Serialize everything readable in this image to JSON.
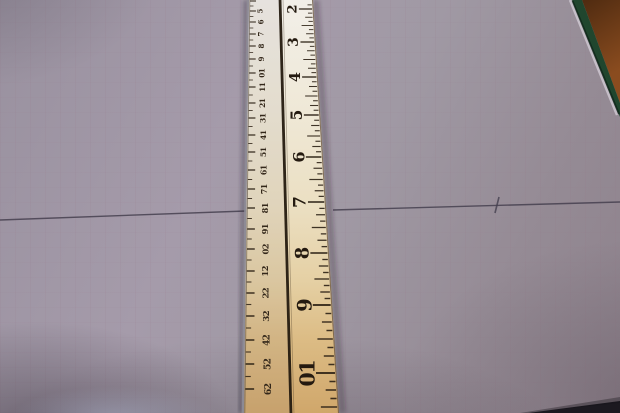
{
  "scene": {
    "colors": {
      "paper_base": "#9d95a1",
      "ruler_top": "#f2efe9",
      "ruler_mid": "#ebdfc2",
      "ruler_bottom": "#d0a76b",
      "marking_dark": "#2b2014",
      "cm_label_color": "#33271a",
      "inch_label_color": "#241a10",
      "pencil": "#45404f",
      "mat_green": "#20462e",
      "wood_dark": "#4e2a10",
      "wood_light": "#8a4c1f",
      "bottom_shadow": "#141118",
      "edge_gray": "#8e8c96"
    },
    "ruler": {
      "geometry": {
        "left_top_x": 249,
        "left_bottom_x": 244,
        "divider_top_x": 280,
        "divider_bottom_x": 291,
        "right_top_x": 313,
        "right_bottom_x": 339,
        "height": 413
      },
      "cm_scale": {
        "unit": "cm",
        "labels": [
          {
            "n": "5",
            "y": 11
          },
          {
            "n": "6",
            "y": 22
          },
          {
            "n": "7",
            "y": 34
          },
          {
            "n": "8",
            "y": 46
          },
          {
            "n": "9",
            "y": 59
          },
          {
            "n": "10",
            "y": 73
          },
          {
            "n": "11",
            "y": 87
          },
          {
            "n": "12",
            "y": 103
          },
          {
            "n": "13",
            "y": 118
          },
          {
            "n": "14",
            "y": 135
          },
          {
            "n": "15",
            "y": 152
          },
          {
            "n": "16",
            "y": 170
          },
          {
            "n": "17",
            "y": 189
          },
          {
            "n": "18",
            "y": 208
          },
          {
            "n": "19",
            "y": 229
          },
          {
            "n": "20",
            "y": 249
          },
          {
            "n": "21",
            "y": 271
          },
          {
            "n": "22",
            "y": 293
          },
          {
            "n": "23",
            "y": 316
          },
          {
            "n": "24",
            "y": 340
          },
          {
            "n": "25",
            "y": 364
          },
          {
            "n": "26",
            "y": 389
          }
        ],
        "extra_tick_y": 1
      },
      "inch_scale": {
        "unit": "inch",
        "subdivisions_per_inch": 8,
        "labels": [
          {
            "n": "2",
            "y": 9
          },
          {
            "n": "3",
            "y": 42
          },
          {
            "n": "4",
            "y": 77
          },
          {
            "n": "5",
            "y": 115
          },
          {
            "n": "6",
            "y": 157
          },
          {
            "n": "7",
            "y": 202
          },
          {
            "n": "8",
            "y": 253
          },
          {
            "n": "9",
            "y": 305
          },
          {
            "n": "10",
            "y": 373
          }
        ]
      }
    },
    "pencil_line": {
      "left_segment": {
        "x1": 0,
        "y1": 220,
        "x2": 246,
        "y2": 211
      },
      "right_segment": {
        "x1": 333,
        "y1": 210,
        "x2": 620,
        "y2": 202
      },
      "tick_mark": {
        "x1": 499,
        "y1": 197,
        "x2": 495,
        "y2": 213
      }
    },
    "paper_corner": {
      "edge_from": {
        "x": 572,
        "y": 0
      },
      "edge_to": {
        "x": 620,
        "y": 117
      },
      "wood_polygon": "582,0 620,0 620,103",
      "mat_polygon": "572,0 582,0 620,103 620,117"
    },
    "bottom_shadow_polygon": "528,413 620,401 620,413"
  }
}
